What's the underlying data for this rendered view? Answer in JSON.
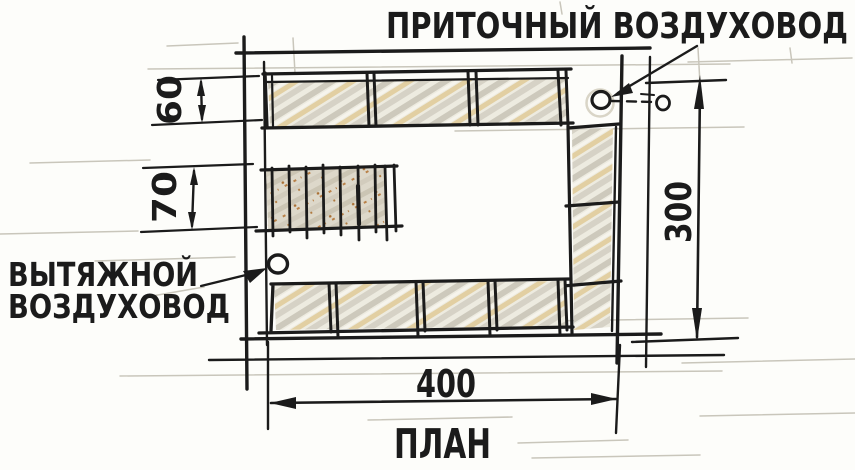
{
  "sketch": {
    "title": "ПЛАН",
    "labels": {
      "supply_duct": "ПРИТОЧНЫЙ ВОЗДУХОВОД",
      "exhaust_duct_line1": "ВЫТЯЖНОЙ",
      "exhaust_duct_line2": "ВОЗДУХОВОД"
    },
    "dimensions": {
      "top_row_depth": "60",
      "center_hatch_depth": "70",
      "plan_side": "300",
      "plan_front": "400"
    },
    "colors": {
      "ink": "#1b1b1b",
      "pencil": "#c9c6bb",
      "shade_gray": "#cdc9bc",
      "shade_tan": "#e2cfa2",
      "shade_rust": "#b07a3e",
      "paper": "#fdfdfa"
    }
  }
}
